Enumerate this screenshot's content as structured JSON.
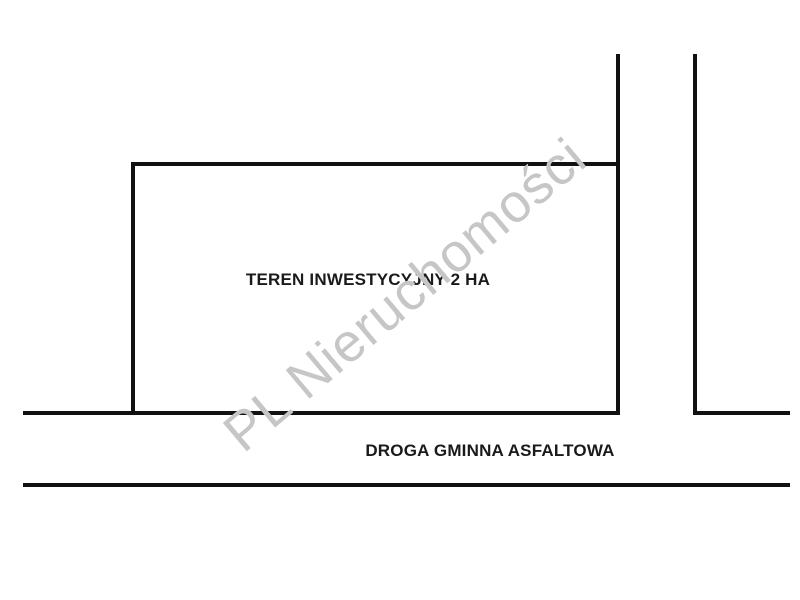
{
  "diagram": {
    "parcel_label": "TEREN INWESTYCYJNY 2 HA",
    "road_label": "DROGA GMINNA ASFALTOWA",
    "watermark": "PL Nieruchomości",
    "colors": {
      "background": "#ffffff",
      "line": "#111111",
      "watermark": "#c6c6c6"
    }
  }
}
